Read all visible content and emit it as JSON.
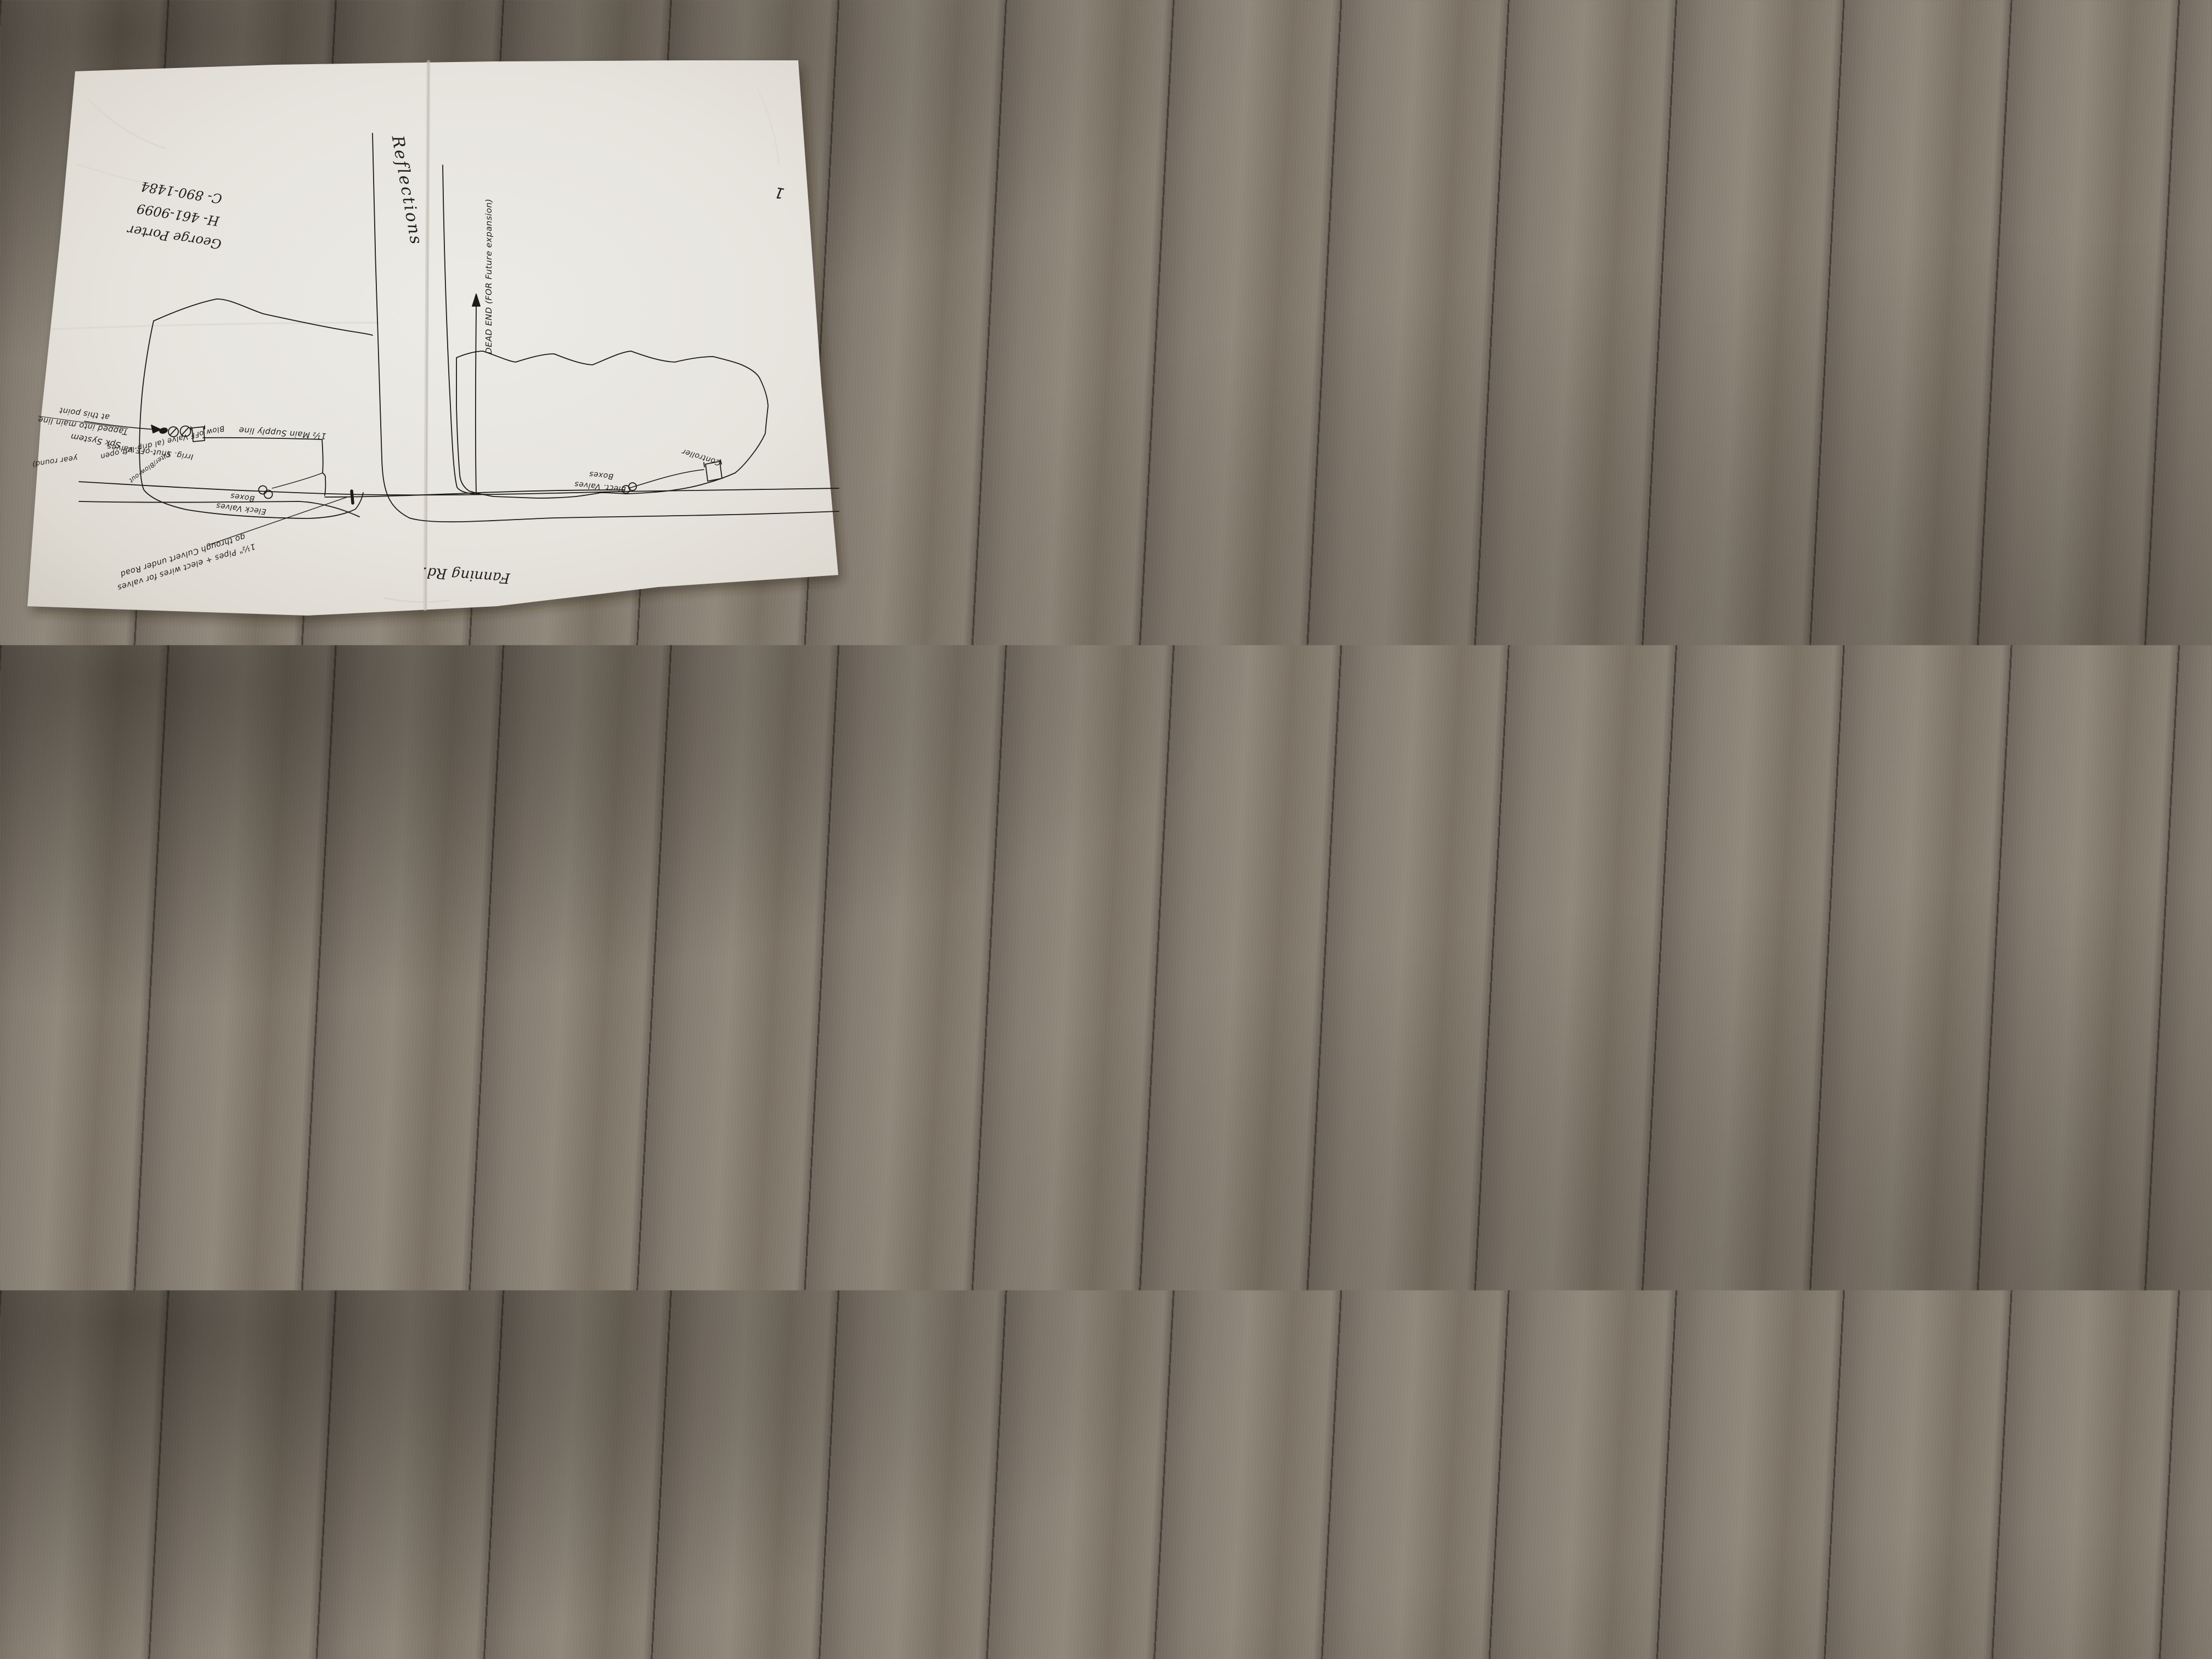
{
  "page_number": "1",
  "streets": {
    "vertical_road": "Reflections",
    "horizontal_road": "Fanning Rd."
  },
  "contact": {
    "name": "George Porter",
    "phone_home": "H- 461-9099",
    "phone_cell": "C- 890-1484"
  },
  "notes": {
    "dead_end": "DEAD END (FOR Future expansion)",
    "supply_line": "1½ Main Supply line",
    "tap_line1": "Tapped into main line",
    "tap_line2": "at this point",
    "system": "Spk System",
    "shutoff": "Irrig. Shut-oFF Valves",
    "blowoff_line1": "Blow oFF Valve (al drip-left open",
    "blowoff_line2": "year round)",
    "filter": "Filter/Blow-out",
    "left_valve_boxes_line1": "Eleck Valves",
    "left_valve_boxes_line2": "Boxes",
    "right_valve_boxes_line1": "Elect. Valves",
    "right_valve_boxes_line2": "Boxes",
    "controller": "Controller",
    "culvert_line1": "1½\" Pipes + elect wires for valves",
    "culvert_line2": "go through Culvert under Road"
  }
}
